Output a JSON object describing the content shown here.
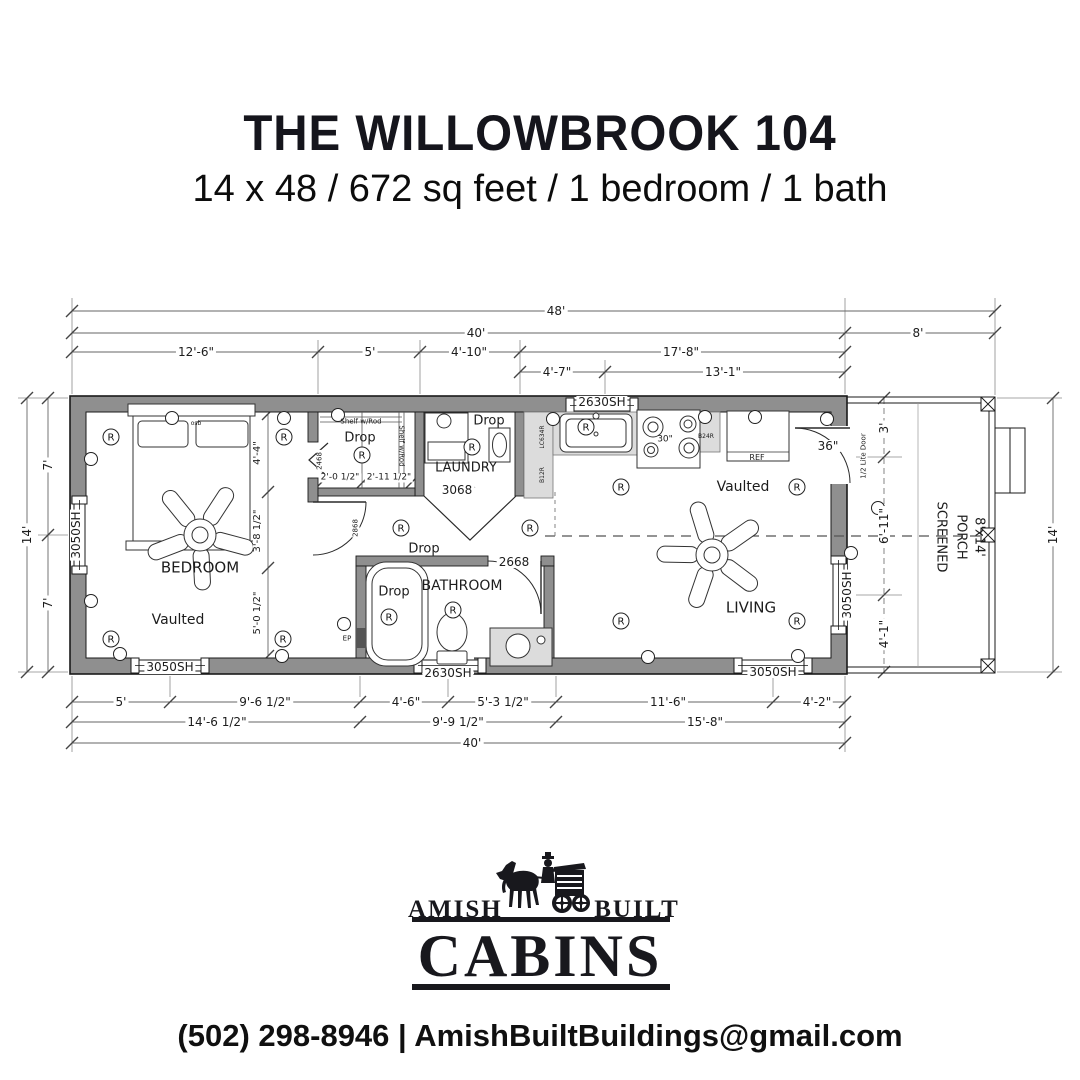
{
  "header": {
    "title": "THE WILLOWBROOK 104",
    "subtitle": "14 x 48 / 672 sq feet / 1 bedroom / 1 bath"
  },
  "footer": {
    "brand_left": "AMISH",
    "brand_right": "BUILT",
    "brand_main": "CABINS",
    "phone": "(502) 298-8946",
    "separator": "|",
    "email": "AmishBuiltBuildings@gmail.com"
  },
  "plan": {
    "colors": {
      "background": "#ffffff",
      "ink": "#111111",
      "wall_gray": "#8f8f8f",
      "counter_gray": "#dcdcdc",
      "dim_line": "#666666"
    },
    "symbols": {
      "recessed_glyph": "R"
    },
    "dim_labels": [
      {
        "text": "48'",
        "x": 556,
        "y": 311
      },
      {
        "text": "40'",
        "x": 476,
        "y": 333
      },
      {
        "text": "8'",
        "x": 918,
        "y": 333
      },
      {
        "text": "12'-6\"",
        "x": 196,
        "y": 352
      },
      {
        "text": "5'",
        "x": 370,
        "y": 352
      },
      {
        "text": "4'-10\"",
        "x": 469,
        "y": 352
      },
      {
        "text": "17'-8\"",
        "x": 681,
        "y": 352
      },
      {
        "text": "4'-7\"",
        "x": 557,
        "y": 372
      },
      {
        "text": "13'-1\"",
        "x": 723,
        "y": 372
      },
      {
        "text": "5'",
        "x": 121,
        "y": 702
      },
      {
        "text": "9'-6 1/2\"",
        "x": 265,
        "y": 702
      },
      {
        "text": "4'-6\"",
        "x": 406,
        "y": 702
      },
      {
        "text": "5'-3 1/2\"",
        "x": 503,
        "y": 702
      },
      {
        "text": "11'-6\"",
        "x": 668,
        "y": 702
      },
      {
        "text": "4'-2\"",
        "x": 817,
        "y": 702
      },
      {
        "text": "14'-6 1/2\"",
        "x": 217,
        "y": 722
      },
      {
        "text": "9'-9 1/2\"",
        "x": 458,
        "y": 722
      },
      {
        "text": "15'-8\"",
        "x": 705,
        "y": 722
      },
      {
        "text": "40'",
        "x": 472,
        "y": 743
      },
      {
        "text": "7'",
        "x": 48,
        "y": 465,
        "rot": -90
      },
      {
        "text": "14'",
        "x": 27,
        "y": 535,
        "rot": -90
      },
      {
        "text": "7'",
        "x": 48,
        "y": 603,
        "rot": -90
      },
      {
        "text": "3'",
        "x": 884,
        "y": 428,
        "rot": -90
      },
      {
        "text": "6'-11\"",
        "x": 884,
        "y": 526,
        "rot": -90
      },
      {
        "text": "4'-1\"",
        "x": 884,
        "y": 634,
        "rot": -90
      },
      {
        "text": "14'",
        "x": 1053,
        "y": 535,
        "rot": -90
      },
      {
        "text": "4'-4\"",
        "x": 258,
        "y": 453,
        "rot": -90,
        "size": 10
      },
      {
        "text": "3'-8 1/2\"",
        "x": 258,
        "y": 531,
        "rot": -90,
        "size": 10
      },
      {
        "text": "5'-0 1/2\"",
        "x": 258,
        "y": 613,
        "rot": -90,
        "size": 10
      },
      {
        "text": "2'-0 1/2\"",
        "x": 340,
        "y": 478,
        "size": 9
      },
      {
        "text": "2'-11 1/2\"",
        "x": 389,
        "y": 478,
        "size": 9
      }
    ],
    "room_labels": [
      {
        "text": "BEDROOM",
        "x": 200,
        "y": 568,
        "size": 15
      },
      {
        "text": "Vaulted",
        "x": 178,
        "y": 620,
        "size": 14
      },
      {
        "text": "LAUNDRY",
        "x": 466,
        "y": 468,
        "size": 13
      },
      {
        "text": "BATHROOM",
        "x": 462,
        "y": 586,
        "size": 14
      },
      {
        "text": "LIVING",
        "x": 751,
        "y": 608,
        "size": 15
      },
      {
        "text": "Vaulted",
        "x": 743,
        "y": 487,
        "size": 14
      },
      {
        "text": "SCREENED",
        "x": 941,
        "y": 537,
        "size": 13,
        "rot": 90
      },
      {
        "text": "PORCH",
        "x": 961,
        "y": 537,
        "size": 13,
        "rot": 90
      },
      {
        "text": "8'x14'",
        "x": 979,
        "y": 537,
        "size": 13,
        "rot": 90
      }
    ],
    "window_labels": [
      {
        "text": "2630SH",
        "x": 602,
        "y": 402
      },
      {
        "text": "3050SH",
        "x": 76,
        "y": 535,
        "rot": -90
      },
      {
        "text": "3050SH",
        "x": 170,
        "y": 667
      },
      {
        "text": "2630SH",
        "x": 448,
        "y": 673
      },
      {
        "text": "3050SH",
        "x": 773,
        "y": 672
      },
      {
        "text": "3050SH",
        "x": 847,
        "y": 595,
        "rot": -90
      }
    ],
    "door_labels": [
      {
        "text": "2468",
        "x": 320,
        "y": 461,
        "rot": -90,
        "size": 7
      },
      {
        "text": "3068",
        "x": 457,
        "y": 490
      },
      {
        "text": "2868",
        "x": 356,
        "y": 528,
        "rot": -90,
        "size": 7
      },
      {
        "text": "2668",
        "x": 514,
        "y": 562
      },
      {
        "text": "36\"",
        "x": 828,
        "y": 446
      },
      {
        "text": "1/2 Lite Door",
        "x": 864,
        "y": 456,
        "rot": -90,
        "size": 7
      }
    ],
    "fixture_labels": [
      {
        "text": "Shelf w/Rod",
        "x": 361,
        "y": 422,
        "size": 7
      },
      {
        "text": "Shelf w/Rod",
        "x": 401,
        "y": 446,
        "rot": 90,
        "size": 7
      },
      {
        "text": "Drop",
        "x": 360,
        "y": 438,
        "size": 13
      },
      {
        "text": "Drop",
        "x": 489,
        "y": 421,
        "size": 13
      },
      {
        "text": "Drop",
        "x": 424,
        "y": 549,
        "size": 13
      },
      {
        "text": "Drop",
        "x": 394,
        "y": 592,
        "size": 13
      },
      {
        "text": "REF",
        "x": 757,
        "y": 458,
        "size": 8
      },
      {
        "text": "30\"",
        "x": 665,
        "y": 440,
        "size": 9
      },
      {
        "text": "B24R",
        "x": 706,
        "y": 437,
        "size": 6
      },
      {
        "text": "LC634R",
        "x": 543,
        "y": 437,
        "rot": -90,
        "size": 6
      },
      {
        "text": "B12R",
        "x": 543,
        "y": 475,
        "rot": -90,
        "size": 6
      },
      {
        "text": "EP",
        "x": 347,
        "y": 639,
        "size": 7
      },
      {
        "text": "osb",
        "x": 196,
        "y": 424,
        "size": 6
      }
    ],
    "recessed_lights": [
      {
        "x": 111,
        "y": 437
      },
      {
        "x": 284,
        "y": 437
      },
      {
        "x": 111,
        "y": 639
      },
      {
        "x": 283,
        "y": 639
      },
      {
        "x": 362,
        "y": 455
      },
      {
        "x": 472,
        "y": 447
      },
      {
        "x": 401,
        "y": 528
      },
      {
        "x": 530,
        "y": 528
      },
      {
        "x": 586,
        "y": 427
      },
      {
        "x": 621,
        "y": 487
      },
      {
        "x": 797,
        "y": 487
      },
      {
        "x": 621,
        "y": 621
      },
      {
        "x": 797,
        "y": 621
      },
      {
        "x": 389,
        "y": 617
      },
      {
        "x": 453,
        "y": 610
      }
    ],
    "wall_lights": [
      {
        "x": 172,
        "y": 418
      },
      {
        "x": 284,
        "y": 418
      },
      {
        "x": 338,
        "y": 415
      },
      {
        "x": 553,
        "y": 419
      },
      {
        "x": 705,
        "y": 417
      },
      {
        "x": 755,
        "y": 417
      },
      {
        "x": 827,
        "y": 419
      },
      {
        "x": 91,
        "y": 459
      },
      {
        "x": 91,
        "y": 601
      },
      {
        "x": 120,
        "y": 654
      },
      {
        "x": 282,
        "y": 656
      },
      {
        "x": 648,
        "y": 657
      },
      {
        "x": 798,
        "y": 656
      },
      {
        "x": 344,
        "y": 624
      },
      {
        "x": 851,
        "y": 553
      },
      {
        "x": 878,
        "y": 508
      }
    ]
  }
}
